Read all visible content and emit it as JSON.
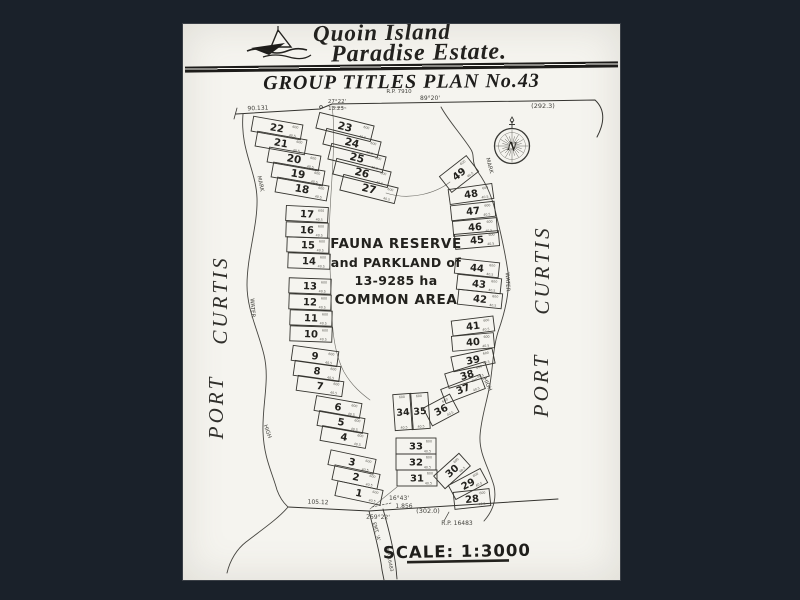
{
  "colors": {
    "background": "#1a212a",
    "page": "#f5f4ef",
    "ink": "#2d2c29",
    "faint_ink": "#55544f"
  },
  "header": {
    "brand_line1": "Quoin Island",
    "brand_line2": "Paradise Estate.",
    "plan_title": "GROUP TITLES PLAN No.43"
  },
  "map": {
    "reserve_lines": [
      "FAUNA RESERVE",
      "and PARKLAND of",
      "13-9285 ha",
      "COMMON AREA"
    ],
    "port_curtis": {
      "word1": "PORT",
      "word2": "CURTIS"
    },
    "compass_letter": "N",
    "scale_label": "SCALE: 1:3000",
    "lot_dims": {
      "area": "600",
      "frontage": "40.5"
    },
    "small_labels": [
      {
        "t": "R.P. 7910",
        "x": 399,
        "y": 93,
        "r": 0,
        "s": 5.5
      },
      {
        "t": "90.131",
        "x": 258,
        "y": 110,
        "r": -2,
        "s": 6
      },
      {
        "t": "27°22'",
        "x": 337,
        "y": 103,
        "r": 0,
        "s": 5.5
      },
      {
        "t": "13.23",
        "x": 336,
        "y": 110,
        "r": 0,
        "s": 5.5
      },
      {
        "t": "89°20'",
        "x": 430,
        "y": 100,
        "r": 0,
        "s": 6
      },
      {
        "t": "(292.3)",
        "x": 543,
        "y": 108,
        "r": 0,
        "s": 6.5
      },
      {
        "t": "105.12",
        "x": 318,
        "y": 504,
        "r": 2,
        "s": 6
      },
      {
        "t": "16°43'",
        "x": 399,
        "y": 500,
        "r": 0,
        "s": 6
      },
      {
        "t": "1.856",
        "x": 404,
        "y": 508,
        "r": 0,
        "s": 6
      },
      {
        "t": "(302.0)",
        "x": 428,
        "y": 513,
        "r": 0,
        "s": 6.5
      },
      {
        "t": "259°22'",
        "x": 378,
        "y": 519,
        "r": 1,
        "s": 6
      },
      {
        "t": "R.P. 16483",
        "x": 457,
        "y": 525,
        "r": 0,
        "s": 6
      },
      {
        "t": "EMT. 'A'",
        "x": 375,
        "y": 532,
        "r": 75,
        "s": 5
      },
      {
        "t": "R.P. 16483",
        "x": 388,
        "y": 560,
        "r": 78,
        "s": 4.6
      },
      {
        "t": "MARK",
        "x": 259,
        "y": 184,
        "r": 78,
        "s": 5.5
      },
      {
        "t": "WATER",
        "x": 251,
        "y": 308,
        "r": 86,
        "s": 5.5
      },
      {
        "t": "HIGH",
        "x": 266,
        "y": 432,
        "r": 70,
        "s": 5.5
      },
      {
        "t": "MARK",
        "x": 488,
        "y": 166,
        "r": 75,
        "s": 5.5
      },
      {
        "t": "WATER",
        "x": 506,
        "y": 282,
        "r": 88,
        "s": 5.5
      },
      {
        "t": "HIGH",
        "x": 486,
        "y": 385,
        "r": 65,
        "s": 5.5
      }
    ],
    "lots": [
      {
        "n": 1,
        "x": 359,
        "y": 493,
        "w": 46,
        "h": 15,
        "r": 12
      },
      {
        "n": 2,
        "x": 356,
        "y": 477,
        "w": 46,
        "h": 15,
        "r": 12
      },
      {
        "n": 3,
        "x": 352,
        "y": 462,
        "w": 46,
        "h": 15,
        "r": 12
      },
      {
        "n": 4,
        "x": 344,
        "y": 437,
        "w": 46,
        "h": 15,
        "r": 10
      },
      {
        "n": 5,
        "x": 341,
        "y": 422,
        "w": 46,
        "h": 15,
        "r": 10
      },
      {
        "n": 6,
        "x": 338,
        "y": 407,
        "w": 46,
        "h": 15,
        "r": 10
      },
      {
        "n": 7,
        "x": 320,
        "y": 386,
        "w": 46,
        "h": 15,
        "r": 8
      },
      {
        "n": 8,
        "x": 317,
        "y": 371,
        "w": 46,
        "h": 15,
        "r": 8
      },
      {
        "n": 9,
        "x": 315,
        "y": 356,
        "w": 46,
        "h": 15,
        "r": 8
      },
      {
        "n": 10,
        "x": 311,
        "y": 334,
        "w": 42,
        "h": 15,
        "r": 2
      },
      {
        "n": 11,
        "x": 311,
        "y": 318,
        "w": 42,
        "h": 15,
        "r": 2
      },
      {
        "n": 12,
        "x": 310,
        "y": 302,
        "w": 42,
        "h": 15,
        "r": 2
      },
      {
        "n": 13,
        "x": 310,
        "y": 286,
        "w": 42,
        "h": 15,
        "r": 2
      },
      {
        "n": 14,
        "x": 309,
        "y": 261,
        "w": 42,
        "h": 15,
        "r": 2
      },
      {
        "n": 15,
        "x": 308,
        "y": 245,
        "w": 42,
        "h": 15,
        "r": 2
      },
      {
        "n": 16,
        "x": 307,
        "y": 230,
        "w": 42,
        "h": 15,
        "r": 2
      },
      {
        "n": 17,
        "x": 307,
        "y": 214,
        "w": 42,
        "h": 15,
        "r": 3
      },
      {
        "n": 18,
        "x": 302,
        "y": 189,
        "w": 52,
        "h": 15,
        "r": 10
      },
      {
        "n": 19,
        "x": 298,
        "y": 174,
        "w": 52,
        "h": 15,
        "r": 10
      },
      {
        "n": 20,
        "x": 294,
        "y": 159,
        "w": 52,
        "h": 15,
        "r": 10
      },
      {
        "n": 21,
        "x": 281,
        "y": 143,
        "w": 50,
        "h": 15,
        "r": 10
      },
      {
        "n": 22,
        "x": 277,
        "y": 128,
        "w": 50,
        "h": 15,
        "r": 10
      },
      {
        "n": 23,
        "x": 345,
        "y": 127,
        "w": 56,
        "h": 16,
        "r": 14
      },
      {
        "n": 24,
        "x": 352,
        "y": 143,
        "w": 56,
        "h": 16,
        "r": 14
      },
      {
        "n": 25,
        "x": 357,
        "y": 158,
        "w": 56,
        "h": 16,
        "r": 14
      },
      {
        "n": 26,
        "x": 362,
        "y": 173,
        "w": 56,
        "h": 16,
        "r": 14
      },
      {
        "n": 27,
        "x": 369,
        "y": 189,
        "w": 56,
        "h": 16,
        "r": 14
      },
      {
        "n": 28,
        "x": 472,
        "y": 499,
        "w": 36,
        "h": 17,
        "r": -6
      },
      {
        "n": 29,
        "x": 468,
        "y": 484,
        "w": 36,
        "h": 16,
        "r": -28
      },
      {
        "n": 30,
        "x": 452,
        "y": 471,
        "w": 34,
        "h": 17,
        "r": -42
      },
      {
        "n": 31,
        "x": 417,
        "y": 478,
        "w": 40,
        "h": 16,
        "r": 0
      },
      {
        "n": 32,
        "x": 416,
        "y": 462,
        "w": 40,
        "h": 16,
        "r": 0
      },
      {
        "n": 33,
        "x": 416,
        "y": 446,
        "w": 40,
        "h": 16,
        "r": 0
      },
      {
        "n": 34,
        "x": 403,
        "y": 412,
        "w": 18,
        "h": 36,
        "r": -4
      },
      {
        "n": 35,
        "x": 420,
        "y": 411,
        "w": 18,
        "h": 36,
        "r": -4
      },
      {
        "n": 36,
        "x": 441,
        "y": 410,
        "w": 30,
        "h": 20,
        "r": -28
      },
      {
        "n": 37,
        "x": 463,
        "y": 389,
        "w": 42,
        "h": 15,
        "r": -21
      },
      {
        "n": 38,
        "x": 467,
        "y": 375,
        "w": 42,
        "h": 15,
        "r": -17
      },
      {
        "n": 39,
        "x": 473,
        "y": 360,
        "w": 42,
        "h": 15,
        "r": -12
      },
      {
        "n": 40,
        "x": 473,
        "y": 342,
        "w": 42,
        "h": 15,
        "r": -5
      },
      {
        "n": 41,
        "x": 473,
        "y": 326,
        "w": 42,
        "h": 15,
        "r": -7
      },
      {
        "n": 42,
        "x": 480,
        "y": 299,
        "w": 44,
        "h": 15,
        "r": 6
      },
      {
        "n": 43,
        "x": 479,
        "y": 284,
        "w": 44,
        "h": 15,
        "r": 6
      },
      {
        "n": 44,
        "x": 477,
        "y": 268,
        "w": 44,
        "h": 15,
        "r": 6
      },
      {
        "n": 45,
        "x": 477,
        "y": 240,
        "w": 44,
        "h": 15,
        "r": -5
      },
      {
        "n": 46,
        "x": 475,
        "y": 227,
        "w": 44,
        "h": 15,
        "r": -5
      },
      {
        "n": 47,
        "x": 473,
        "y": 211,
        "w": 44,
        "h": 15,
        "r": -6
      },
      {
        "n": 48,
        "x": 471,
        "y": 194,
        "w": 44,
        "h": 15,
        "r": -8
      },
      {
        "n": 49,
        "x": 459,
        "y": 174,
        "w": 34,
        "h": 20,
        "r": -38
      }
    ]
  }
}
